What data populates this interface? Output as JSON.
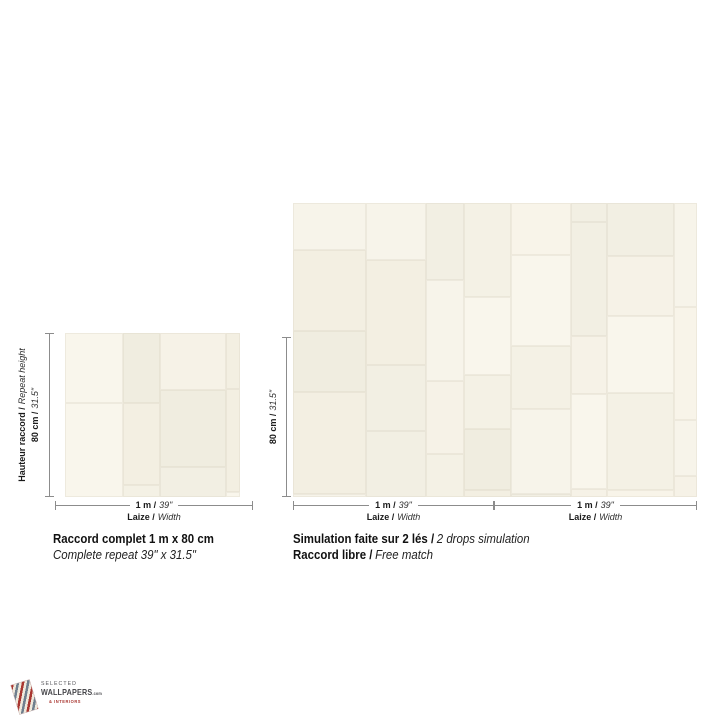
{
  "page": {
    "background_color": "#ffffff"
  },
  "swatch": {
    "base_color": "#f5f1e6",
    "patch_colors": [
      "#f7f4ea",
      "#f2efe3",
      "#f6f2e7",
      "#f0ede0",
      "#f9f6ec",
      "#f4f1e5",
      "#f3efe2",
      "#f8f4e9"
    ],
    "seam_color": "#e0dccb"
  },
  "dimension_line_color": "#8c8c8c",
  "left_diagram": {
    "height_label_bold": "Hauteur raccord /",
    "height_label_italic": "Repeat height",
    "height_value_bold": "80 cm /",
    "height_value_italic": "31.5\"",
    "width_value_bold": "1 m /",
    "width_value_italic": "39\"",
    "width_label_bold": "Laize /",
    "width_label_italic": "Width",
    "caption_bold": "Raccord complet 1 m x 80 cm",
    "caption_italic": "Complete repeat 39\" x 31.5\""
  },
  "right_diagram": {
    "height_value_bold": "80 cm /",
    "height_value_italic": "31.5\"",
    "drops": [
      {
        "width_value_bold": "1 m /",
        "width_value_italic": "39\"",
        "width_label_bold": "Laize /",
        "width_label_italic": "Width"
      },
      {
        "width_value_bold": "1 m /",
        "width_value_italic": "39\"",
        "width_label_bold": "Laize /",
        "width_label_italic": "Width"
      }
    ],
    "caption1_bold": "Simulation faite sur 2 lés /",
    "caption1_italic": "2 drops simulation",
    "caption2_bold": "Raccord libre /",
    "caption2_italic": "Free match"
  },
  "logo": {
    "line1": "SELECTED",
    "line2": "WALLPAPERS",
    "line2_suffix": ".com",
    "line3": "& INTERIORS",
    "accent_red": "#a93630",
    "accent_slate": "#6f7f8e",
    "text_dark": "#47474b"
  }
}
